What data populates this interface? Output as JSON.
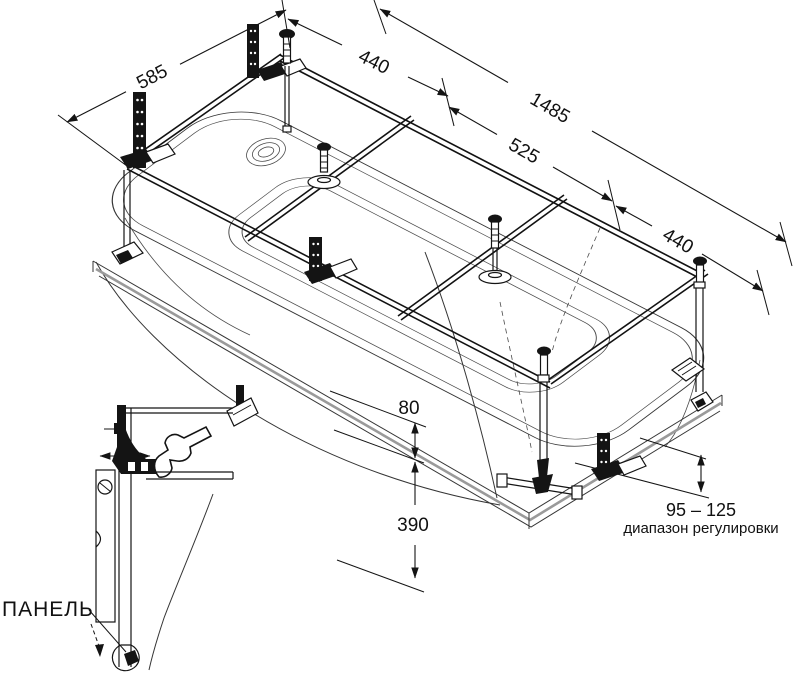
{
  "frame_dimensions": {
    "width": "585",
    "left_section": "440",
    "total_length": "1485",
    "middle_section": "525",
    "right_section": "440"
  },
  "height_dimensions": {
    "rim_offset": "80",
    "rim_to_floor": "390"
  },
  "adjustment": {
    "range": "95 – 125",
    "caption": "диапазон регулировки"
  },
  "detail_view": {
    "panel_label": "ПАНЕЛЬ"
  },
  "colors": {
    "line": "#141414",
    "shadow": "#9a9a9a",
    "background": "#ffffff"
  }
}
